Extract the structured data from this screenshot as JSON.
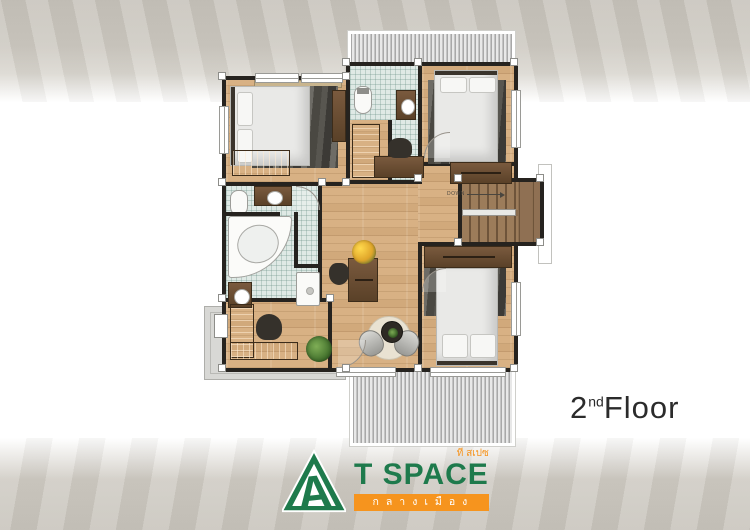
{
  "floor_label": {
    "number": "2",
    "ordinal": "nd",
    "word": "Floor"
  },
  "plan": {
    "down_label": "DOWN"
  },
  "logo": {
    "thai_small": "ที สเปซ",
    "title": "T SPACE",
    "banner": "กลางเมือง"
  },
  "colors": {
    "brand_green": "#1e7a4c",
    "brand_orange": "#f6941e",
    "wall": "#26231f",
    "wood": "#d8b184",
    "wood_dark": "#6b4e35",
    "tile": "#dfe9e5",
    "rug": "#55534d",
    "roof_stripe": "#c7c7c7",
    "balcony": "#d8d8d5",
    "label_text": "#2b2b2b"
  }
}
